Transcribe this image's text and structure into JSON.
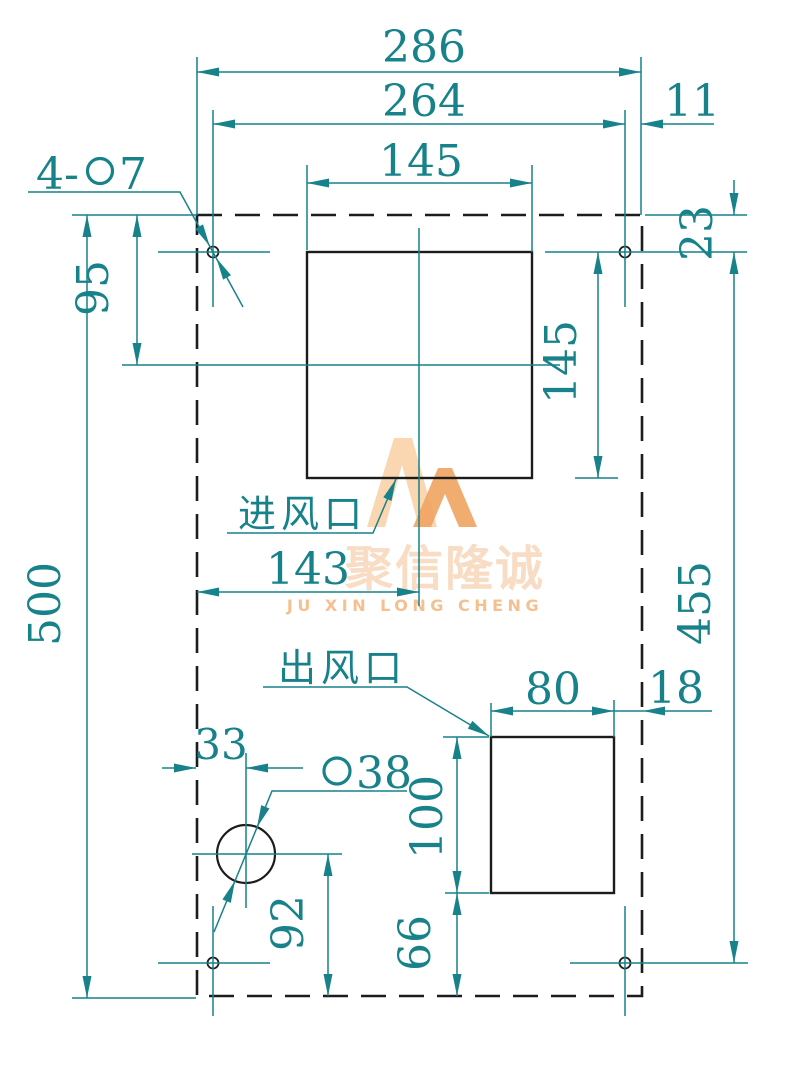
{
  "drawing": {
    "type": "panel cutout dimension drawing",
    "labels": {
      "inlet": "进风口",
      "outlet": "出风口",
      "hole_callout_prefix": "4-",
      "hole_callout_diameter": "7",
      "circle_callout_diameter": "38"
    },
    "dimensions": {
      "overall_width": "286",
      "inner_width": "264",
      "hole_edge_offset": "11",
      "inlet_width": "145",
      "inlet_height": "145",
      "inlet_top_offset": "95",
      "hole_top_offset": "23",
      "overall_height": "500",
      "hole_span_height": "455",
      "inlet_center_x": "143",
      "outlet_width": "80",
      "outlet_edge_offset": "18",
      "outlet_height": "100",
      "outlet_bottom_offset": "66",
      "circle_offset_x": "33",
      "circle_bottom_offset": "92"
    },
    "colors": {
      "dimension_teal": "#17828a",
      "outline_black": "#1c1c1c",
      "watermark_orange": "#f2a765",
      "watermark_light": "#fad2a8"
    }
  },
  "watermark": {
    "cjk": "聚信隆诚",
    "latin": "JU XIN LONG CHENG"
  }
}
